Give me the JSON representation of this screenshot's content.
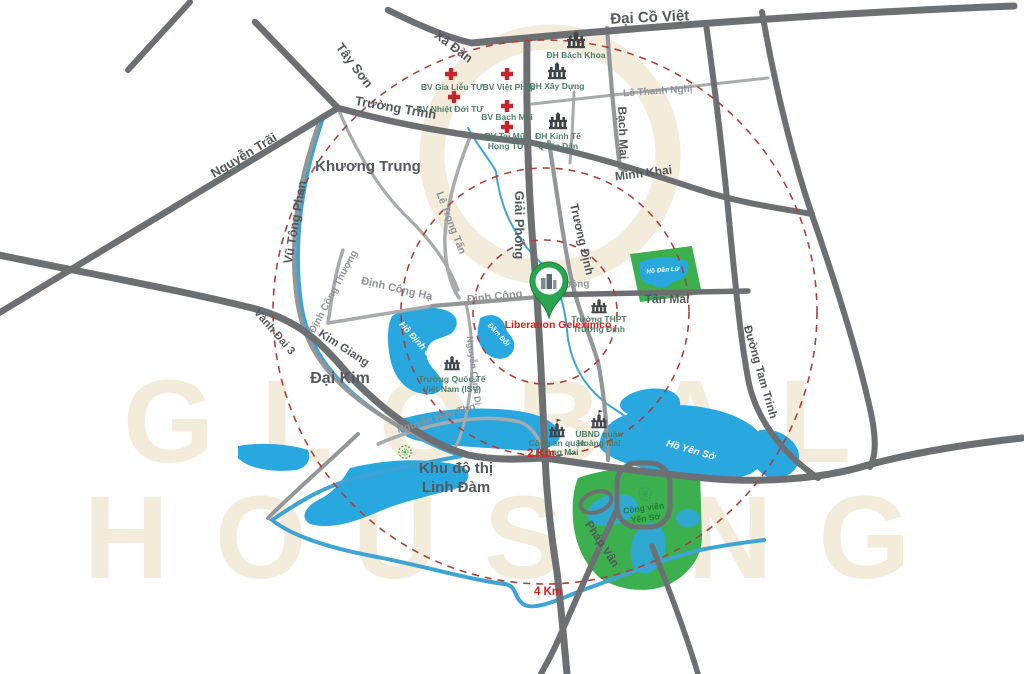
{
  "watermark": {
    "line1": "GLOBAL",
    "line2": "HOUSING"
  },
  "rings": {
    "r2": "2 Km",
    "r4": "4 Km"
  },
  "project": {
    "name": "Liberation Geleximco"
  },
  "areas": {
    "khuong_trung": "Khương Trung",
    "dai_kim": "Đại Kim",
    "linh_dam_1": "Khu đô thị",
    "linh_dam_2": "Linh Đàm"
  },
  "streets": {
    "dai_co_viet": "Đại Cồ Việt",
    "xa_dan": "Xã Đàn",
    "tay_son": "Tây Sơn",
    "truong_trinh": "Trường Trinh",
    "nguyen_trai": "Nguyễn Trãi",
    "vu_tong_phan": "Vũ Tông Phan",
    "le_trong_tan": "Lê Trọng Tấn",
    "giai_phong": "Giải Phóng",
    "truong_dinh": "Trương Định",
    "bach_mai": "Bạch Mai",
    "minh_khai": "Minh Khai",
    "le_thanh_nghi": "Lê Thanh Nghị",
    "dinh_cong_thuong": "Định Công Thượng",
    "dinh_cong_ha": "Định Công Hạ",
    "dinh_cong": "Định Công",
    "kim_dong": "Kim Đồng",
    "tan_mai": "Tân Mai",
    "duong_tam_trinh": "Đường Tam Trinh",
    "kim_giang": "Kim Giang",
    "vanh_dai_3": "Vành Đai 3",
    "nguyen_huu_tho": "Nguyễn Hữu Thọ",
    "nguyen_canh_di": "Nguyễn Cảnh Dị",
    "phap_van": "Pháp Vân"
  },
  "hospitals": {
    "gia_lieu": "BV Gia Liễu TƯ",
    "viet_phap": "BV Việt Pháp",
    "nhiet_doi": "BV Nhiệt Đới TƯ",
    "bach_mai": "BV Bạch Mai",
    "tai_mui_1": "BV Tai Mũi",
    "tai_mui_2": "Họng TƯ"
  },
  "education": {
    "bach_khoa": "ĐH Bách Khoa",
    "xay_dung": "ĐH Xây Dựng",
    "kinh_te_1": "ĐH Kinh Tế",
    "kinh_te_2": "Quốc Dân",
    "thpt_1": "Trường THPT",
    "thpt_2": "Trương Định",
    "isv_1": "Trường Quốc Tế",
    "isv_2": "Việt Nam (ISV)"
  },
  "government": {
    "cong_an_1": "Công an quận",
    "cong_an_2": "Hoàng Mai",
    "ubnd_1": "UBND quận",
    "ubnd_2": "Hoàng Mai"
  },
  "water": {
    "ho_dinh_cong": "Hồ Định Công",
    "dam_doi": "Đầm Đỗi",
    "ho_yen_so": "Hồ Yên Sở",
    "ho_den_lu": "Hồ Đền Lừ"
  },
  "parks": {
    "yen_so_1": "Công viên",
    "yen_so_2": "Yên Sở"
  },
  "colors": {
    "road_primary": "#6d7073",
    "road_secondary": "#a8abad",
    "water": "#29a8e0",
    "river": "#3fa3d3",
    "park": "#3cb04f",
    "radius_ring": "#a8403c",
    "project_accent": "#e11d1d",
    "poi_label": "#4c7d6b",
    "pin": "#2aa353",
    "watermark": "#f3ecda"
  }
}
